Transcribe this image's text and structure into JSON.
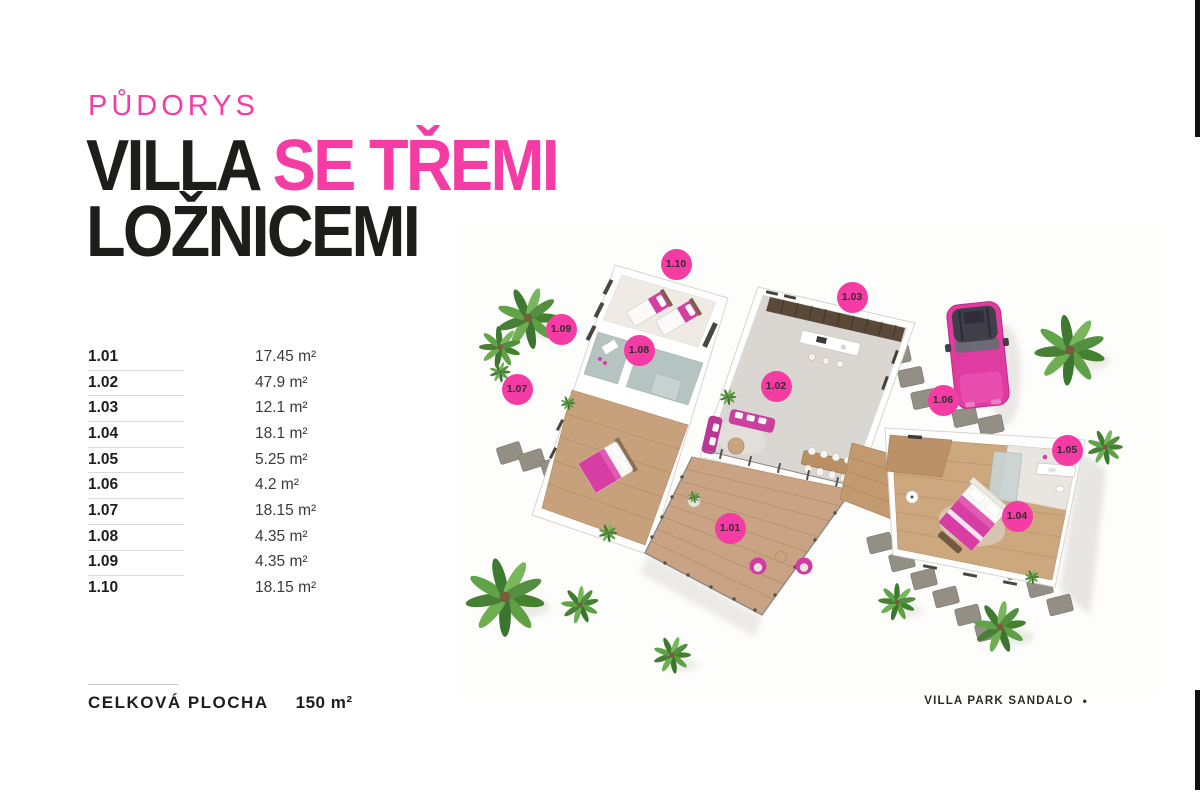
{
  "page": {
    "eyebrow": "PŮDORYS",
    "title": {
      "black": "VILLA ",
      "pink": "SE TŘEMI",
      "line2": "LOŽNICEMI"
    }
  },
  "rooms": [
    {
      "id": "1.01",
      "area": "17.45 m²"
    },
    {
      "id": "1.02",
      "area": "47.9 m²"
    },
    {
      "id": "1.03",
      "area": "12.1 m²"
    },
    {
      "id": "1.04",
      "area": "18.1 m²"
    },
    {
      "id": "1.05",
      "area": "5.25 m²"
    },
    {
      "id": "1.06",
      "area": "4.2 m²"
    },
    {
      "id": "1.07",
      "area": "18.15 m²"
    },
    {
      "id": "1.08",
      "area": "4.35 m²"
    },
    {
      "id": "1.09",
      "area": "4.35 m²"
    },
    {
      "id": "1.10",
      "area": "18.15 m²"
    }
  ],
  "plan": {
    "markers": [
      {
        "label": "1.01"
      },
      {
        "label": "1.02"
      },
      {
        "label": "1.03"
      },
      {
        "label": "1.04"
      },
      {
        "label": "1.05"
      },
      {
        "label": "1.06"
      },
      {
        "label": "1.07"
      },
      {
        "label": "1.08"
      },
      {
        "label": "1.09"
      },
      {
        "label": "1.10"
      }
    ]
  },
  "summary": {
    "label": "CELKOVÁ PLOCHA",
    "value": "150 m²"
  },
  "footer": {
    "brand": "VILLA PARK SANDALO",
    "bullet": "•"
  },
  "colors": {
    "accent": "#F53CA4",
    "ink": "#1D1D1B"
  }
}
